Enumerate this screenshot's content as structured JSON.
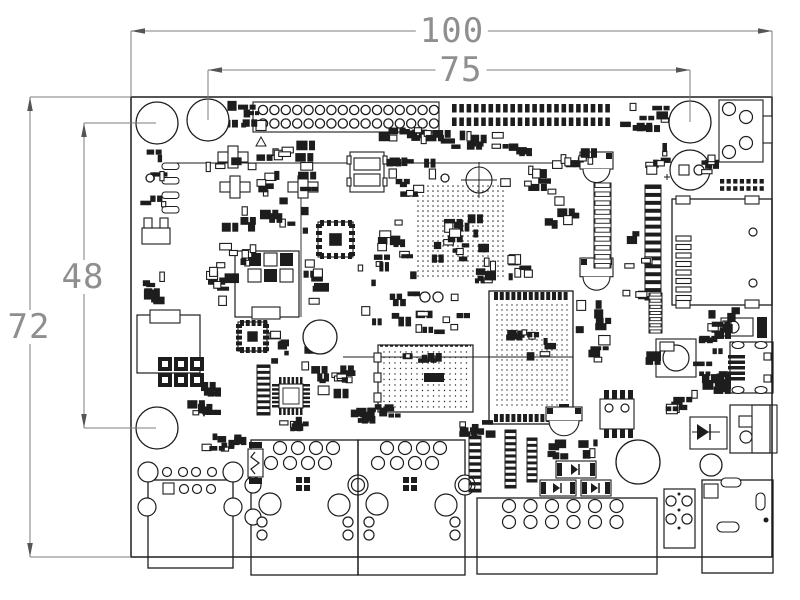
{
  "drawing": {
    "type": "pcb-mechanical-dimension-drawing",
    "bg_color": "#ffffff",
    "line_color": "#1d1d1d",
    "dim_line_color": "#7c7c7c",
    "dim_text_color": "#8f8f8f"
  },
  "dimensions": {
    "board_width": "100",
    "top_span": "75",
    "left_span": "48",
    "board_height": "72"
  },
  "labels": [
    {
      "name": "dim-label-100",
      "key": "board_width",
      "x": 452,
      "y": 31
    },
    {
      "name": "dim-label-75",
      "key": "top_span",
      "x": 461,
      "y": 70
    },
    {
      "name": "dim-label-48",
      "key": "left_span",
      "x": 83,
      "y": 277
    },
    {
      "name": "dim-label-72",
      "key": "board_height",
      "x": 29,
      "y": 327
    }
  ],
  "board": {
    "x": 131,
    "y": 97,
    "w": 641,
    "h": 460
  },
  "dim_lines": [
    [
      131,
      31,
      772,
      31
    ],
    [
      208,
      70,
      690,
      70
    ],
    [
      84,
      123,
      84,
      428
    ],
    [
      30,
      97,
      30,
      557
    ]
  ],
  "ext_lines": [
    [
      131,
      31,
      131,
      97
    ],
    [
      772,
      31,
      772,
      97
    ],
    [
      208,
      70,
      208,
      120
    ],
    [
      690,
      70,
      690,
      122
    ],
    [
      84,
      123,
      156,
      123
    ],
    [
      84,
      428,
      156,
      428
    ],
    [
      30,
      97,
      131,
      97
    ],
    [
      30,
      557,
      131,
      557
    ]
  ],
  "arrows": [
    [
      131,
      31,
      "l"
    ],
    [
      772,
      31,
      "r"
    ],
    [
      208,
      70,
      "l"
    ],
    [
      690,
      70,
      "r"
    ],
    [
      84,
      123,
      "u"
    ],
    [
      84,
      428,
      "d"
    ],
    [
      30,
      97,
      "u"
    ],
    [
      30,
      557,
      "d"
    ]
  ],
  "holes": [
    [
      157,
      123,
      21
    ],
    [
      208,
      120,
      21
    ],
    [
      690,
      122,
      21
    ],
    [
      157,
      428,
      21
    ],
    [
      638,
      462,
      22
    ],
    [
      320,
      337,
      17
    ],
    [
      711,
      465,
      11
    ],
    [
      150,
      178,
      4
    ],
    [
      425,
      297,
      5
    ],
    [
      438,
      297,
      5
    ],
    [
      445,
      178,
      4
    ]
  ],
  "lines": [
    [
      172,
      163,
      572,
      163
    ],
    [
      343,
      357,
      573,
      357
    ],
    [
      301,
      196,
      301,
      317
    ]
  ],
  "components": [
    {
      "t": "thheader",
      "name": "gpio-header-2x16",
      "x": 263,
      "y": 110,
      "cols": 16,
      "px": 11.4,
      "py": 13.5,
      "r": 4.6,
      "box": [
        253,
        102,
        186,
        30
      ],
      "sq": [
        256,
        117,
        10
      ]
    },
    {
      "t": "tri",
      "name": "pin1-marker",
      "pts": "256,146 266,146 261,137",
      "fill": false
    },
    {
      "t": "smdheader",
      "name": "smd-header-2x22",
      "x": 452,
      "y": 104,
      "cols": 22,
      "px": 7.3,
      "py": 13.5,
      "w": 4.6,
      "h": 8.5
    },
    {
      "t": "smdheader",
      "name": "smd-header-2x7",
      "x": 720,
      "y": 179,
      "cols": 7,
      "px": 6.6,
      "py": 7.2,
      "w": 4.2,
      "h": 4.6
    },
    {
      "t": "audio",
      "name": "audio-jack",
      "x": 719,
      "y": 100
    },
    {
      "t": "ecap",
      "name": "electrolytic-capacitor",
      "x": 690,
      "y": 170
    },
    {
      "t": "sd",
      "name": "sd-card-slot",
      "x": 672,
      "y": 199
    },
    {
      "t": "switch",
      "name": "tactile-switch",
      "x": 721,
      "y": 318
    },
    {
      "t": "musb",
      "name": "micro-usb-connector",
      "x": 730,
      "y": 342
    },
    {
      "t": "buzzer",
      "name": "inductor-can",
      "x": 656,
      "y": 339
    },
    {
      "t": "usba",
      "name": "usb-connector"
    },
    {
      "t": "rj45",
      "name": "ethernet-jack-1",
      "x": 251,
      "left": true
    },
    {
      "t": "rj45",
      "name": "ethernet-jack-2",
      "x": 358,
      "left": false
    },
    {
      "t": "conn12",
      "name": "bottom-header-12pin"
    },
    {
      "t": "conn4",
      "name": "bottom-connector-4pin"
    },
    {
      "t": "barrel",
      "name": "dc-barrel-jack"
    },
    {
      "t": "usbb2",
      "name": "usb-otg-connector"
    },
    {
      "t": "dwrect",
      "name": "diode-block",
      "x": 690,
      "y": 417
    },
    {
      "t": "soic",
      "name": "soic8-ic",
      "x": 600,
      "y": 399
    },
    {
      "t": "module",
      "name": "soc-module"
    },
    {
      "t": "bga",
      "name": "via-array"
    },
    {
      "t": "dmodule",
      "name": "wifi-module"
    },
    {
      "t": "qfn",
      "name": "qfn-ic-1",
      "x": 318,
      "y": 222,
      "s": 35
    },
    {
      "t": "qfn",
      "name": "qfn-ic-2",
      "x": 238,
      "y": 322,
      "s": 29
    },
    {
      "t": "qfp",
      "name": "qfp-ic",
      "x": 272,
      "y": 377,
      "s": 38
    },
    {
      "t": "shield1",
      "name": "shield-outline-1"
    },
    {
      "t": "shield2",
      "name": "shield-outline-2"
    },
    {
      "t": "grid32",
      "name": "pad-grid-3x2",
      "x": 158,
      "y": 357
    },
    {
      "t": "can",
      "name": "metal-can-1",
      "x": 580,
      "y": 152,
      "w": 33,
      "h": 31
    },
    {
      "t": "can",
      "name": "metal-can-2",
      "x": 580,
      "y": 258,
      "w": 33,
      "h": 34
    },
    {
      "t": "can",
      "name": "metal-can-3",
      "x": 546,
      "y": 407,
      "w": 36,
      "h": 25
    },
    {
      "t": "plus",
      "name": "transistor-1",
      "x": 218,
      "y": 146
    },
    {
      "t": "plus",
      "name": "transistor-2",
      "x": 220,
      "y": 176
    },
    {
      "t": "plus",
      "name": "transistor-3",
      "x": 288,
      "y": 176
    },
    {
      "t": "ovals",
      "name": "inductor-pads",
      "x": 162,
      "y": 163,
      "n": 4,
      "pitch": 14.5
    },
    {
      "t": "ucomp",
      "name": "crystal-footprint",
      "x": 142,
      "y": 218
    },
    {
      "t": "wres",
      "name": "fuse-resistor",
      "x": 248,
      "y": 449
    },
    {
      "t": "dsmd",
      "name": "smd-diode-1",
      "x": 556,
      "y": 461,
      "w": 40,
      "h": 17
    },
    {
      "t": "dsmd",
      "name": "smd-diode-2",
      "x": 540,
      "y": 480,
      "w": 36,
      "h": 16
    },
    {
      "t": "dsmd",
      "name": "smd-diode-3",
      "x": 581,
      "y": 480,
      "w": 30,
      "h": 16
    },
    {
      "t": "vstripe",
      "name": "pin-strip-1",
      "x": 469,
      "y": 436,
      "w": 12,
      "h": 56,
      "n": 9,
      "dark": true
    },
    {
      "t": "vstripe",
      "name": "pin-strip-2",
      "x": 505,
      "y": 430,
      "w": 11,
      "h": 58,
      "n": 10,
      "dark": true
    },
    {
      "t": "vstripe",
      "name": "pin-strip-3",
      "x": 527,
      "y": 438,
      "w": 10,
      "h": 44,
      "n": 8,
      "dark": true
    },
    {
      "t": "vstripe",
      "name": "pin-strip-4",
      "x": 257,
      "y": 365,
      "w": 13,
      "h": 50,
      "n": 9,
      "dark": true
    },
    {
      "t": "vstripe",
      "name": "fpc-connector",
      "x": 645,
      "y": 185,
      "w": 16,
      "h": 115,
      "n": 15,
      "dark": true
    },
    {
      "t": "vstripe",
      "name": "pad-ladder-1",
      "x": 594,
      "y": 183,
      "w": 17,
      "h": 85,
      "n": 10,
      "dark": false
    },
    {
      "t": "vstripe",
      "name": "pad-ladder-2",
      "x": 649,
      "y": 293,
      "w": 13,
      "h": 40,
      "n": 7,
      "dark": false
    },
    {
      "t": "relay",
      "name": "relay-footprint",
      "x": 350,
      "y": 152,
      "w": 34,
      "h": 40
    },
    {
      "t": "fid",
      "name": "fiducial-crosshair",
      "x": 479,
      "y": 180,
      "r": 13
    },
    {
      "t": "tri",
      "name": "diode-marker",
      "pts": "199,407 209,407 204,416",
      "fill": true
    }
  ],
  "clusters": [
    [
      205,
      148,
      110,
      92,
      24,
      1,
      0.6
    ],
    [
      255,
      140,
      58,
      22,
      7,
      2,
      0.5
    ],
    [
      386,
      152,
      55,
      48,
      11,
      3,
      0.55
    ],
    [
      450,
      128,
      58,
      32,
      9,
      4,
      0.7
    ],
    [
      500,
      142,
      48,
      52,
      10,
      5,
      0.5
    ],
    [
      543,
      160,
      34,
      78,
      9,
      6,
      0.45
    ],
    [
      617,
      103,
      52,
      32,
      9,
      7,
      0.8
    ],
    [
      644,
      140,
      30,
      44,
      7,
      8,
      0.6
    ],
    [
      620,
      228,
      34,
      72,
      8,
      10,
      0.5
    ],
    [
      700,
      136,
      16,
      38,
      5,
      11,
      0.7
    ],
    [
      352,
      218,
      58,
      42,
      9,
      12,
      0.5
    ],
    [
      355,
      258,
      62,
      72,
      12,
      13,
      0.55
    ],
    [
      302,
      256,
      24,
      58,
      7,
      14,
      0.6
    ],
    [
      140,
      148,
      26,
      62,
      8,
      15,
      0.65
    ],
    [
      138,
      270,
      28,
      36,
      7,
      16,
      0.7
    ],
    [
      205,
      240,
      52,
      28,
      8,
      17,
      0.5
    ],
    [
      206,
      266,
      30,
      44,
      7,
      18,
      0.45
    ],
    [
      185,
      378,
      33,
      38,
      8,
      19,
      0.6
    ],
    [
      193,
      431,
      57,
      24,
      9,
      20,
      0.85
    ],
    [
      266,
      330,
      45,
      42,
      9,
      21,
      0.55
    ],
    [
      308,
      358,
      48,
      52,
      9,
      22,
      0.55
    ],
    [
      415,
      290,
      52,
      55,
      9,
      23,
      0.5
    ],
    [
      473,
      252,
      20,
      50,
      6,
      24,
      0.7
    ],
    [
      482,
      252,
      55,
      34,
      8,
      25,
      0.5
    ],
    [
      575,
      296,
      45,
      68,
      10,
      26,
      0.55
    ],
    [
      700,
      307,
      40,
      30,
      7,
      27,
      0.6
    ],
    [
      692,
      330,
      36,
      64,
      13,
      28,
      0.85
    ],
    [
      660,
      386,
      42,
      32,
      7,
      29,
      0.6
    ],
    [
      545,
      436,
      58,
      26,
      9,
      30,
      0.8
    ],
    [
      458,
      418,
      38,
      20,
      7,
      31,
      0.8
    ],
    [
      218,
      100,
      40,
      30,
      8,
      32,
      0.8
    ],
    [
      378,
      126,
      46,
      17,
      7,
      33,
      0.75
    ],
    [
      410,
      129,
      42,
      15,
      6,
      34,
      0.75
    ],
    [
      275,
      416,
      32,
      16,
      6,
      35,
      0.6
    ],
    [
      336,
      365,
      20,
      18,
      5,
      36,
      0.6
    ],
    [
      348,
      404,
      50,
      26,
      12,
      37,
      0.85
    ],
    [
      645,
      342,
      13,
      24,
      4,
      38,
      0.8
    ],
    [
      560,
      140,
      34,
      26,
      6,
      42,
      0.5
    ]
  ]
}
